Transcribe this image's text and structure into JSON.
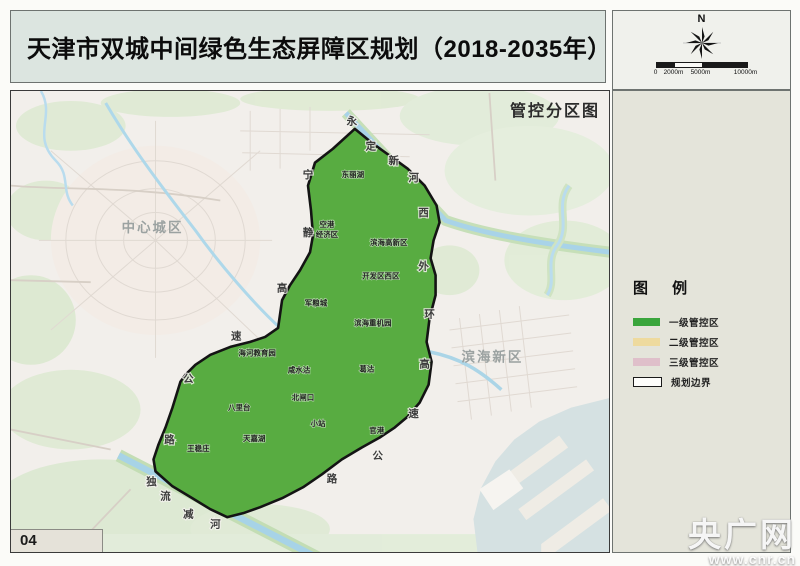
{
  "title": "天津市双城中间绿色生态屏障区规划（2018-2035年）",
  "map_subtitle": "管控分区图",
  "page_number": "04",
  "north": {
    "label": "N"
  },
  "scale_bar": {
    "ticks": [
      "0",
      "2000m",
      "5000m",
      "10000m"
    ]
  },
  "legend": {
    "title": "图  例",
    "items": [
      {
        "label": "一级管控区",
        "color": "#3aa53c",
        "type": "fill"
      },
      {
        "label": "二级管控区",
        "color": "#eeda9e",
        "type": "fill"
      },
      {
        "label": "三级管控区",
        "color": "#dfbfca",
        "type": "fill"
      },
      {
        "label": "规划边界",
        "color": "#ffffff",
        "type": "boundary"
      }
    ]
  },
  "watermark": {
    "name": "央广网",
    "url_text": "www.cnr.cn"
  },
  "map": {
    "area_labels": [
      {
        "text": "中心城区",
        "x": 142,
        "y": 137
      },
      {
        "text": "滨海新区",
        "x": 483,
        "y": 267
      }
    ],
    "zone_labels": [
      {
        "text": "东丽湖",
        "x": 343,
        "y": 84
      },
      {
        "text": "空港经济区",
        "lines": [
          "空港",
          "经济区"
        ],
        "x": 317,
        "y": 139
      },
      {
        "text": "滨海高新区",
        "x": 379,
        "y": 152
      },
      {
        "text": "开发区西区",
        "x": 371,
        "y": 186
      },
      {
        "text": "军粮城",
        "x": 306,
        "y": 213
      },
      {
        "text": "滨海重机园",
        "x": 363,
        "y": 233
      },
      {
        "text": "海河教育园",
        "x": 247,
        "y": 263
      },
      {
        "text": "咸水沽",
        "x": 289,
        "y": 280
      },
      {
        "text": "葛沽",
        "x": 357,
        "y": 279
      },
      {
        "text": "八里台",
        "x": 229,
        "y": 318
      },
      {
        "text": "北闸口",
        "x": 293,
        "y": 308
      },
      {
        "text": "小站",
        "x": 308,
        "y": 334
      },
      {
        "text": "官港",
        "x": 367,
        "y": 341
      },
      {
        "text": "天嘉湖",
        "x": 244,
        "y": 349
      },
      {
        "text": "王稳庄",
        "x": 188,
        "y": 359
      }
    ],
    "route_labels": [
      {
        "name": "宁静高速公路",
        "chars": [
          {
            "c": "宁",
            "x": 298,
            "y": 85
          },
          {
            "c": "静",
            "x": 298,
            "y": 143
          },
          {
            "c": "高",
            "x": 272,
            "y": 199
          },
          {
            "c": "速",
            "x": 226,
            "y": 247
          },
          {
            "c": "公",
            "x": 178,
            "y": 290
          },
          {
            "c": "路",
            "x": 159,
            "y": 351
          }
        ]
      },
      {
        "name": "西外环高速公路",
        "chars": [
          {
            "c": "西",
            "x": 414,
            "y": 123
          },
          {
            "c": "外",
            "x": 414,
            "y": 177
          },
          {
            "c": "环",
            "x": 420,
            "y": 225
          },
          {
            "c": "高",
            "x": 415,
            "y": 275
          },
          {
            "c": "速",
            "x": 404,
            "y": 325
          },
          {
            "c": "公",
            "x": 368,
            "y": 367
          },
          {
            "c": "路",
            "x": 322,
            "y": 390
          }
        ]
      },
      {
        "name": "永定新河",
        "chars": [
          {
            "c": "永",
            "x": 342,
            "y": 31
          },
          {
            "c": "定",
            "x": 361,
            "y": 56
          },
          {
            "c": "新",
            "x": 384,
            "y": 71
          },
          {
            "c": "河",
            "x": 404,
            "y": 88
          }
        ]
      },
      {
        "name": "独流减河",
        "chars": [
          {
            "c": "独",
            "x": 141,
            "y": 393
          },
          {
            "c": "流",
            "x": 155,
            "y": 408
          },
          {
            "c": "减",
            "x": 178,
            "y": 426
          },
          {
            "c": "河",
            "x": 205,
            "y": 436
          }
        ]
      }
    ]
  }
}
